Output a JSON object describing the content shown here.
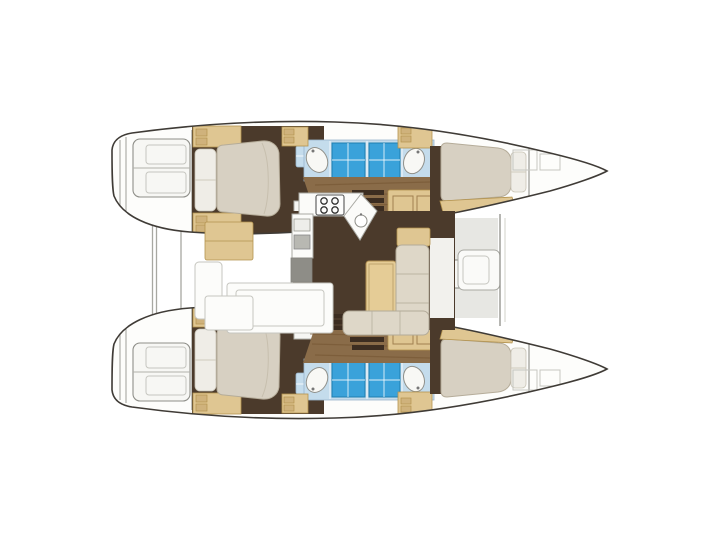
{
  "figure": {
    "type": "catamaran-floor-plan",
    "description": "Top-view interior layout plan of a 4-cabin sailing catamaran, bows pointing right, no visible text labels"
  },
  "palette": {
    "outline": "#3f3b36",
    "hull-fill": "#fdfdfb",
    "step-fill": "#f7f7f4",
    "step-stroke": "#8f8f89",
    "faint-stroke": "#c6c6c0",
    "deck-gray": "#e7e7e3",
    "beam-stroke": "#a8a8a2",
    "wood-tan": "#dfc692",
    "wood-tan-dark": "#b3934f",
    "wood-drawer": "#cfb27c",
    "floor-dark": "#4b3a2b",
    "floor-wood": "#8a6c49",
    "wood-streak": "#73532f",
    "step-dark": "#3c2d21",
    "bed-cream": "#d7d0c2",
    "bed-stroke": "#b5ac99",
    "pillow": "#efede7",
    "sofa-cream": "#ded7c8",
    "sofa-stroke": "#b3ab99",
    "tile-blue": "#c4dcec",
    "shower-blue": "#3aa2da",
    "shower-stroke": "#1f7fb0",
    "counter-white": "#fbfbf9",
    "counter-stroke": "#a8a8a2",
    "appliance-gray": "#8e8d87",
    "table-tan": "#e5cc96",
    "table-stroke": "#b08e50",
    "vanity-stroke": "#90908a"
  },
  "elements": [
    "hull-port",
    "hull-starboard",
    "transom-steps",
    "aft-cabin-bed",
    "midship-bathrooms",
    "shower-trays",
    "washbasins",
    "forward-cabin-bed",
    "forepeak",
    "saloon-floor",
    "galley-counter",
    "stove",
    "sink",
    "dinette-table",
    "dinette-sofa",
    "aft-cockpit",
    "forward-cockpit-seat",
    "crossbeams"
  ]
}
